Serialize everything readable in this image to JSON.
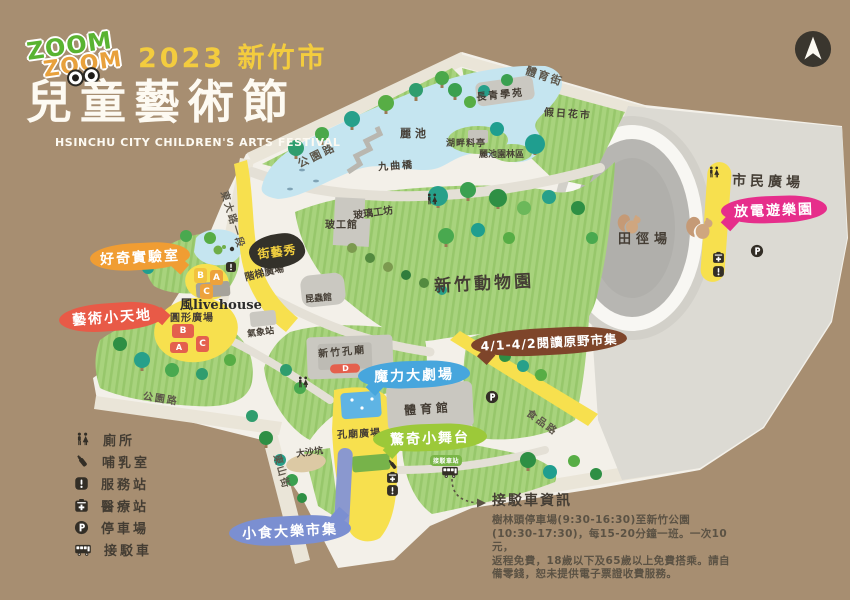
{
  "header": {
    "logo_zoom_top": "ZOOM",
    "logo_zoom_bottom": "ZOOM",
    "year_city": "2023 新竹市",
    "title": "兒童藝術節",
    "subtitle": "HSINCHU CITY CHILDREN'S ARTS FESTIVAL"
  },
  "roads": [
    {
      "id": "gongyuan-road-north",
      "label": "公園路"
    },
    {
      "id": "dongda-road-sec1",
      "label": "東大路一段"
    },
    {
      "id": "tiyu-street",
      "label": "體育街"
    },
    {
      "id": "shipin-road",
      "label": "食品路"
    },
    {
      "id": "dongshan-street",
      "label": "東山街"
    },
    {
      "id": "gongyuan-road-southwest",
      "label": "公園路"
    }
  ],
  "places": [
    {
      "id": "li-pond",
      "label": "麗池"
    },
    {
      "id": "nine-turn-bridge",
      "label": "九曲橋"
    },
    {
      "id": "lakeside-pavilion",
      "label": "湖畔料亭"
    },
    {
      "id": "li-pond-garden",
      "label": "麗池園林區"
    },
    {
      "id": "evergreen-academy",
      "label": "長青學苑"
    },
    {
      "id": "holiday-flower-market",
      "label": "假日花市"
    },
    {
      "id": "glass-workshop",
      "label": "玻璃工坊"
    },
    {
      "id": "glass-museum",
      "label": "玻工館"
    },
    {
      "id": "hsinchu-zoo",
      "label": "新竹動物園"
    },
    {
      "id": "citizens-plaza",
      "label": "市民廣場"
    },
    {
      "id": "athletics-field",
      "label": "田徑場"
    },
    {
      "id": "stairs-plaza",
      "label": "階梯廣場"
    },
    {
      "id": "wind-livehouse",
      "label": "風livehouse"
    },
    {
      "id": "round-plaza",
      "label": "圓形廣場"
    },
    {
      "id": "weather-station",
      "label": "氣象站"
    },
    {
      "id": "insect-museum",
      "label": "昆蟲館"
    },
    {
      "id": "confucius-temple",
      "label": "新竹孔廟"
    },
    {
      "id": "gymnasium",
      "label": "體育館"
    },
    {
      "id": "temple-plaza",
      "label": "孔廟廣場"
    },
    {
      "id": "big-sand-pit",
      "label": "大沙坑"
    }
  ],
  "bubbles": [
    {
      "id": "curiosity-lab",
      "label": "好奇實驗室",
      "color": "#f09d33"
    },
    {
      "id": "art-little-land",
      "label": "藝術小天地",
      "color": "#e85a47"
    },
    {
      "id": "street-art-show",
      "label": "街藝秀",
      "color": "#33312a",
      "text_color": "#f2cf3f"
    },
    {
      "id": "discharge-playground",
      "label": "放電遊樂園",
      "color": "#e62e8b"
    },
    {
      "id": "magic-theater",
      "label": "魔力大劇場",
      "color": "#47a6dd"
    },
    {
      "id": "surprise-stage",
      "label": "驚奇小舞台",
      "color": "#9cc939"
    },
    {
      "id": "snack-market",
      "label": "小食大樂市集",
      "color": "#7b8fd1"
    },
    {
      "id": "reading-field-market",
      "label": "4/1-4/2閱讀原野市集",
      "color": "#7e452a"
    }
  ],
  "markers": {
    "stage_blocks_orange": [
      "B",
      "A",
      "C"
    ],
    "stage_blocks_red": [
      "B",
      "A",
      "C"
    ],
    "temple_marker": "D",
    "shuttle_stop": "接駁車站"
  },
  "legend": {
    "items": [
      {
        "icon": "wc-icon",
        "label": "廁所"
      },
      {
        "icon": "bottle-icon",
        "label": "哺乳室"
      },
      {
        "icon": "service-icon",
        "label": "服務站"
      },
      {
        "icon": "medical-icon",
        "label": "醫療站"
      },
      {
        "icon": "parking-icon",
        "label": "停車場"
      },
      {
        "icon": "bus-icon",
        "label": "接駁車"
      }
    ]
  },
  "shuttle_info": {
    "title": "接駁車資訊",
    "lines": [
      "樹林頭停車場(9:30-16:30)至新竹公園",
      "(10:30-17:30)，每15-20分鐘一班。一次10元，",
      "返程免費，18歲以下及65歲以上免費搭乘。請自",
      "備零錢，恕未提供電子票證收費服務。"
    ]
  },
  "colors": {
    "background": "#a78e71",
    "park_base": "#f3f0e9",
    "grass": "#a8d37d",
    "lake": "#c5e5f0",
    "plaza": "#dcdad3",
    "track_infield": "#b7b6b2",
    "venue_yellow": "#f7e04e",
    "title_yellow": "#f3cc3e",
    "title_white": "#fdfaf2"
  }
}
